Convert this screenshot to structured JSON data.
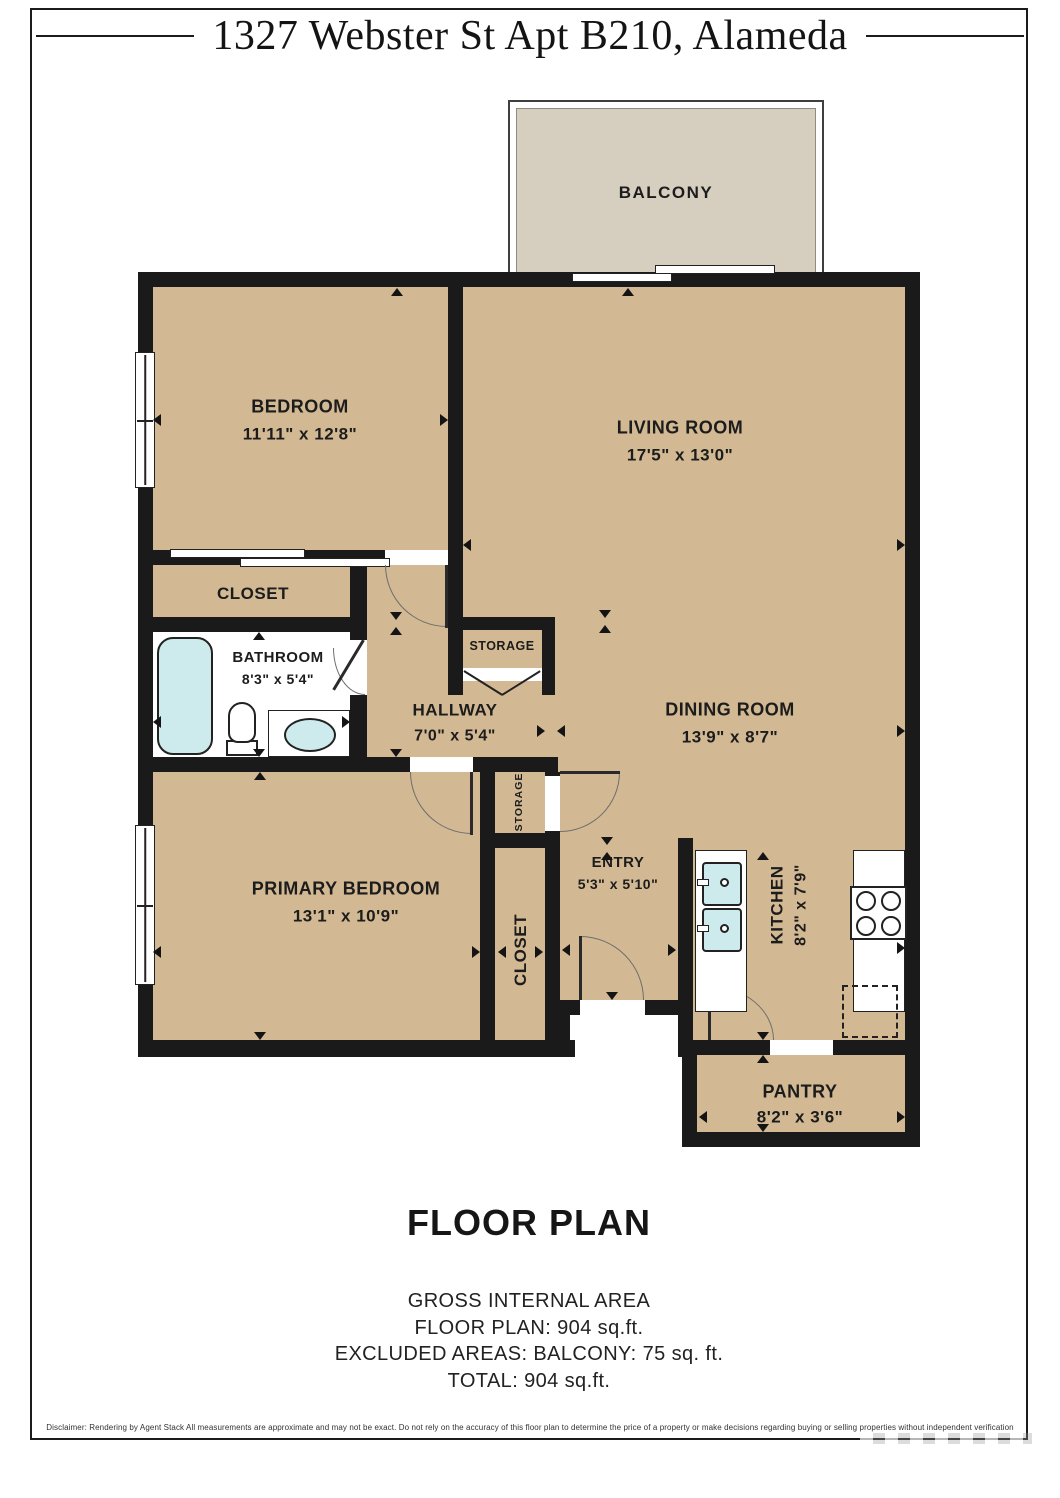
{
  "page": {
    "title": "1327 Webster St Apt B210, Alameda"
  },
  "plan": {
    "balcony": {
      "name": "BALCONY"
    },
    "rooms": {
      "bedroom": {
        "name": "BEDROOM",
        "dims": "11'11\" x 12'8\""
      },
      "living_room": {
        "name": "LIVING ROOM",
        "dims": "17'5\" x 13'0\""
      },
      "closet": {
        "name": "CLOSET"
      },
      "bathroom": {
        "name": "BATHROOM",
        "dims": "8'3\" x 5'4\""
      },
      "storage_upper": {
        "name": "STORAGE"
      },
      "hallway": {
        "name": "HALLWAY",
        "dims": "7'0\" x 5'4\""
      },
      "dining_room": {
        "name": "DINING ROOM",
        "dims": "13'9\" x 8'7\""
      },
      "storage_lower": {
        "name": "STORAGE"
      },
      "primary_bedroom": {
        "name": "PRIMARY BEDROOM",
        "dims": "13'1\" x 10'9\""
      },
      "primary_closet": {
        "name": "CLOSET"
      },
      "entry": {
        "name": "ENTRY",
        "dims": "5'3\" x 5'10\""
      },
      "kitchen": {
        "name": "KITCHEN",
        "dims": "8'2\" x 7'9\""
      },
      "pantry": {
        "name": "PANTRY",
        "dims": "8'2\" x 3'6\""
      }
    }
  },
  "footer": {
    "heading": "FLOOR PLAN",
    "area_lines": [
      "GROSS INTERNAL AREA",
      "FLOOR PLAN: 904 sq.ft.",
      "EXCLUDED AREAS: BALCONY: 75 sq. ft.",
      "TOTAL: 904 sq.ft."
    ],
    "disclaimer": "Disclaimer: Rendering by Agent Stack All measurements are approximate and may not be exact. Do not rely on the accuracy of this floor plan to determine the price of a property or make decisions regarding buying or selling properties without independent verification"
  },
  "colors": {
    "floor": "#d2b993",
    "balcony": "#d6cfc0",
    "wall": "#1a1a1a",
    "fixture": "#cdeaec"
  }
}
